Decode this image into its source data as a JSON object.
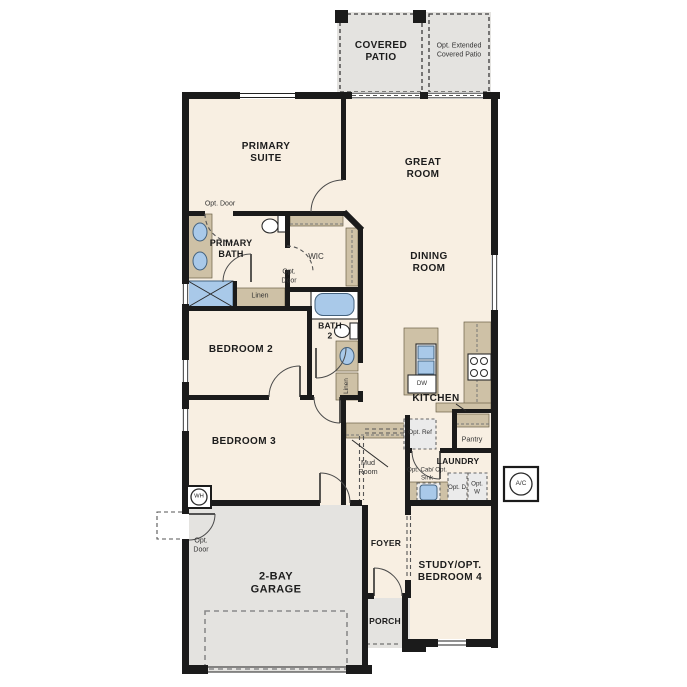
{
  "plan_title": "Single-story floor plan",
  "colors": {
    "wall": "#1b1b1b",
    "floor": "#f8efe2",
    "concrete": "#e4e3e0",
    "counter": "#cec1a6",
    "fixture": "#a9c9e9"
  },
  "rooms": {
    "covered_patio": "COVERED PATIO",
    "opt_extended_patio": "Opt. Extended Covered Patio",
    "primary_suite": "PRIMARY SUITE",
    "great_room": "GREAT ROOM",
    "dining_room": "DINING ROOM",
    "primary_bath": "PRIMARY BATH",
    "wic": "WIC",
    "bath_2": "BATH 2",
    "bedroom_2": "BEDROOM 2",
    "bedroom_3": "BEDROOM 3",
    "kitchen": "KITCHEN",
    "pantry": "Pantry",
    "laundry": "LAUNDRY",
    "mud_room": "Mud Room",
    "foyer": "FOYER",
    "porch": "PORCH",
    "study_bedroom_4": "STUDY/OPT. BEDROOM 4",
    "garage": "2-BAY GARAGE"
  },
  "annotations": {
    "opt_door": "Opt. Door",
    "linen": "Linen",
    "opt_ref": "Opt. Ref",
    "opt_cab_sink": "Opt. Cab/ Opt. Sink",
    "opt_dryer": "Opt. D",
    "opt_washer": "Opt. W",
    "dishwasher": "DW",
    "water_heater": "WH",
    "ac_unit": "A/C"
  }
}
